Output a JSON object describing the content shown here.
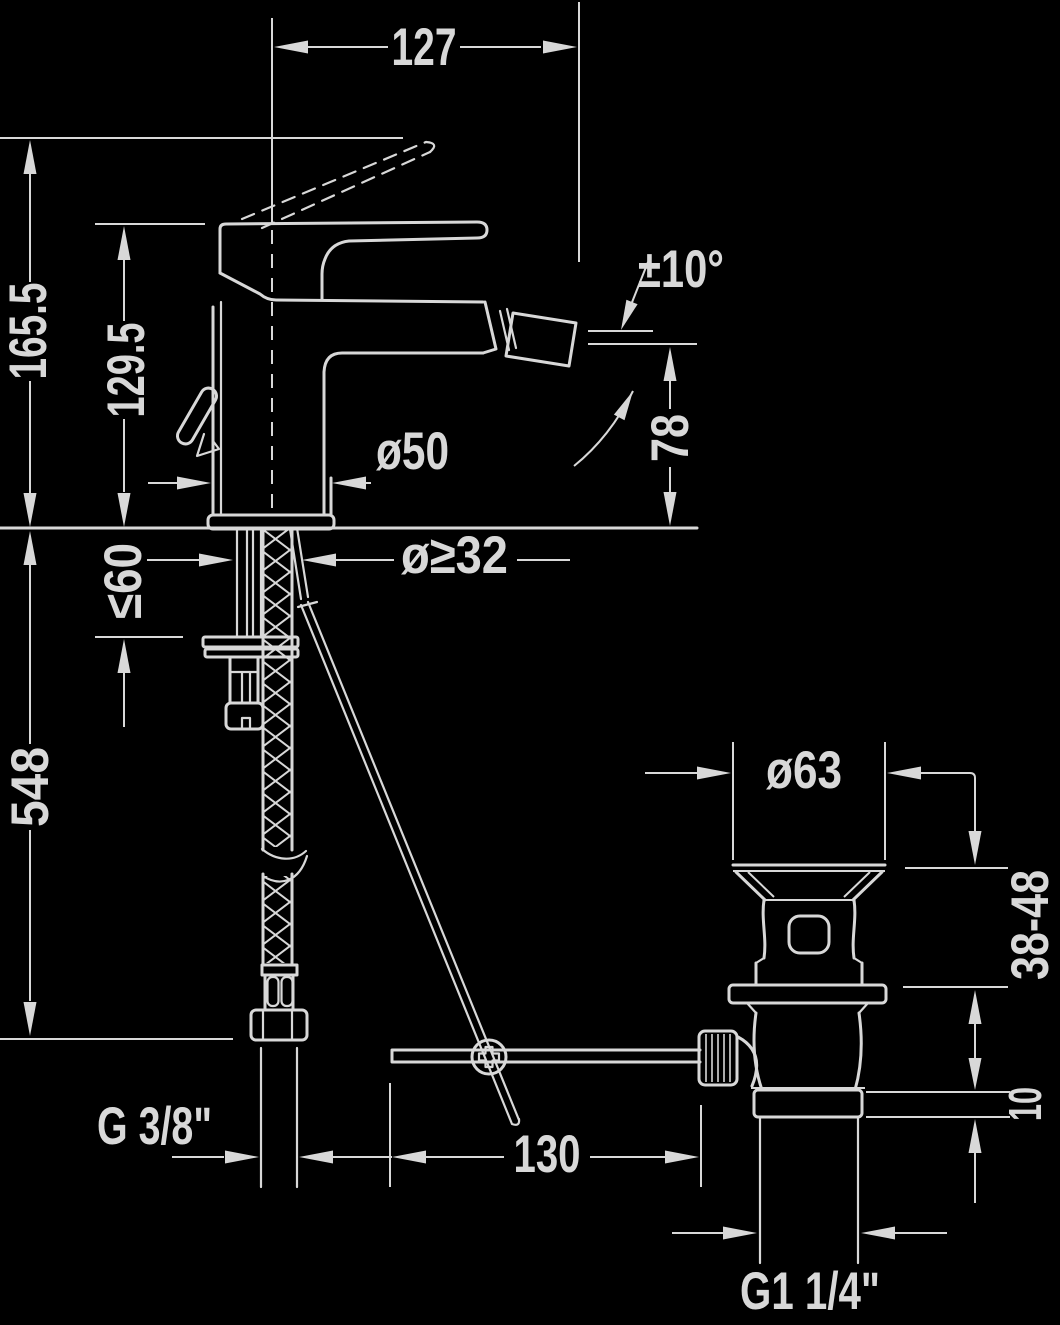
{
  "title": "Bidet single-lever mixer – dimensional drawing",
  "colors": {
    "background": "#000000",
    "ink": "#d8d8d8"
  },
  "dimensions": {
    "spout_reach": "127",
    "total_height": "165.5",
    "body_height": "129.5",
    "spout_swivel_angle": "±10°",
    "outlet_height": "78",
    "body_diameter": "ø50",
    "hole_diameter": "ø≥32",
    "max_deck_thickness": "≤60",
    "hose_drop": "548",
    "waste_flange_diameter": "ø63",
    "clamping_range": "38-48",
    "flange_height": "10",
    "supply_thread": "G 3/8\"",
    "rod_offset": "130",
    "waste_thread": "G1 1/4\""
  }
}
